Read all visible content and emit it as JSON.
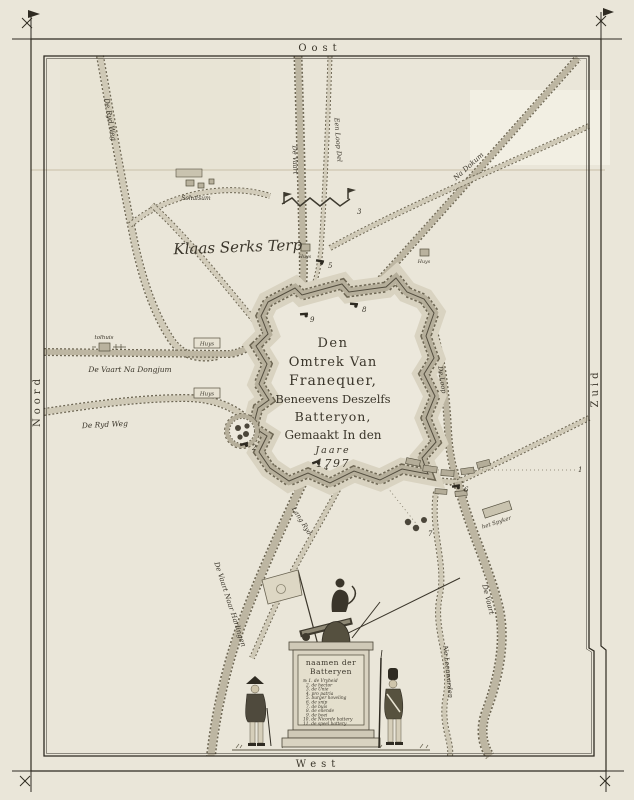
{
  "map": {
    "compass": {
      "east": "Oost",
      "west": "West",
      "north": "Noord",
      "south": "Zuid"
    },
    "cartouche": {
      "lines": [
        "Den",
        "Omtrek Van",
        "Franequer,",
        "Beneevens Deszelfs",
        "Batteryon,",
        "Gemaakt In den",
        "Jaare",
        "1797"
      ]
    },
    "road_labels": {
      "ryd_weg_nw": "De Ryd Weg",
      "vaart_dongjum": "De Vaart Na Dongjum",
      "ryd_weg_w": "De Ryd Weg",
      "vaart_harlingen": "De Vaart Naar Harlingen",
      "lang_ryd": "Lang Ryd",
      "vaart_s": "De Vaart",
      "na_leeuwarden": "Na Leeuwarden",
      "na_dokum": "Na Dokum",
      "een_loop_del": "Een Loop Del",
      "de_vaart_n": "De Vaart",
      "de_loop": "De Loop"
    },
    "place_labels": {
      "schalsum": "Schalsum",
      "klaas_serks_terp": "Klaas Serks Terp",
      "tolhuis": "tolhuis",
      "huys_box_1": "Huys",
      "huys_box_2": "Huys",
      "huys_1": "Huys",
      "huys_2": "Huys",
      "het_spyker": "het Spyker"
    },
    "batteries": {
      "n1": "1",
      "n2": "2",
      "n3": "3",
      "n4": "4",
      "n5": "5",
      "n6": "6",
      "n7": "7",
      "n8": "8",
      "n9": "9"
    },
    "monument": {
      "title_lines": [
        "naamen der",
        "Batteryen"
      ],
      "entries": [
        "№ 1. de Vryheid",
        "2. de hector",
        "3. de Unie",
        "4. pro patria",
        "5. burger hoveling",
        "6. de snip",
        "7. de buis",
        "8. de ellende",
        "9. de boei",
        "10. de Nicorde battery",
        "11. de speel battery"
      ]
    }
  }
}
